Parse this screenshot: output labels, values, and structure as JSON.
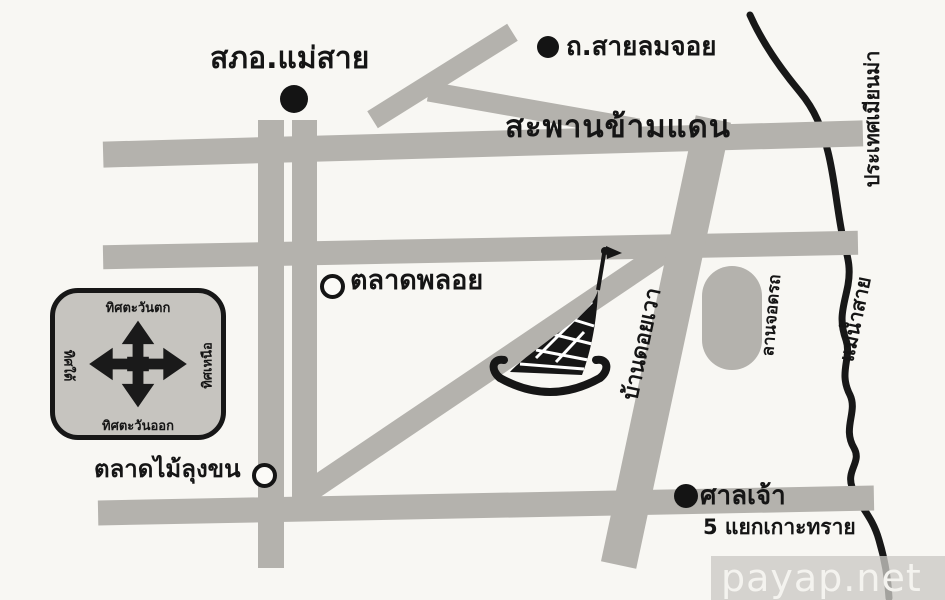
{
  "colors": {
    "background": "#f8f7f3",
    "road_gray": "#b4b2ad",
    "ink": "#1a1a1a",
    "compass_panel": "#c6c4bf",
    "watermark_text": "#f4f3ef"
  },
  "labels": {
    "police_station": "สภอ.แม่สาย",
    "sai_lom_joy_road": "ถ.สายลมจอย",
    "border_bridge": "สะพานข้ามแดน",
    "ploy_market": "ตลาดพลอย",
    "ban_doi_wao": "บ้านดอยเวา",
    "parking_area": "ลานจอดรถ",
    "myanmar_country": "ประเทศเมียนม่า",
    "sai_river": "แม่น้ำสาย",
    "shrine": "ศาลเจ้า",
    "koh_sai_junction": "5 แยกเกาะทราย",
    "mai_lung_khon_market": "ตลาดไม้ลุงขน"
  },
  "compass": {
    "top": "ทิศตะวันตก",
    "bottom": "ทิศตะวันออก",
    "left": "ทิศใต้",
    "right": "ทิศเหนือ"
  },
  "watermark": "payap.net"
}
